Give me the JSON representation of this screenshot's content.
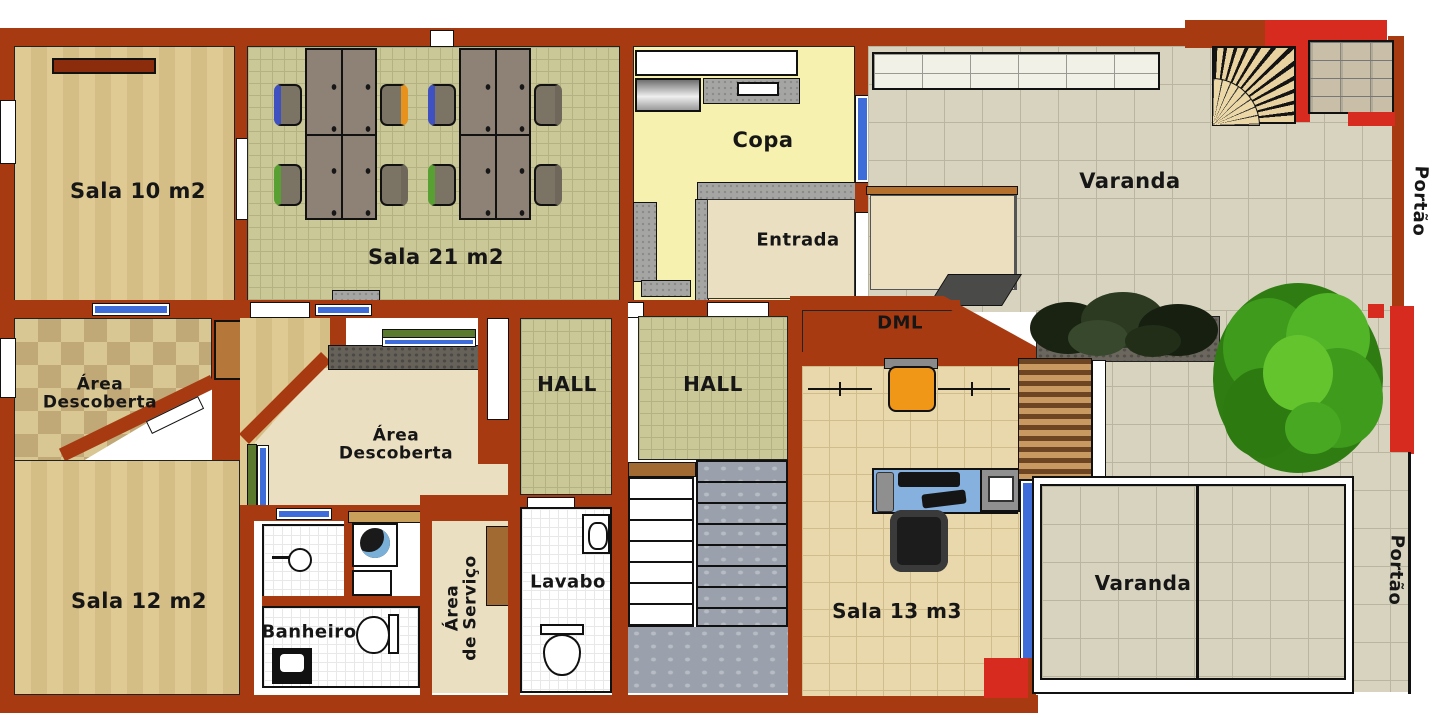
{
  "rooms": {
    "sala10": {
      "label": "Sala 10 m2"
    },
    "sala21": {
      "label": "Sala 21 m2"
    },
    "copa": {
      "label": "Copa"
    },
    "entrada": {
      "label": "Entrada"
    },
    "varanda_top": {
      "label": "Varanda"
    },
    "portao_top": {
      "label": "Portão"
    },
    "dml": {
      "label": "DML"
    },
    "area_descoberta_left": {
      "line1": "Área",
      "line2": "Descoberta"
    },
    "area_descoberta_mid": {
      "line1": "Área",
      "line2": "Descoberta"
    },
    "hall_left": {
      "label": "HALL"
    },
    "hall_mid": {
      "label": "HALL"
    },
    "sala12": {
      "label": "Sala 12 m2"
    },
    "banheiro": {
      "label": "Banheiro"
    },
    "area_servico": {
      "line1": "Área",
      "line2": "de Serviço"
    },
    "lavabo": {
      "label": "Lavabo"
    },
    "sala13": {
      "label": "Sala 13 m3"
    },
    "varanda_bottom": {
      "label": "Varanda"
    },
    "portao_bottom": {
      "label": "Portão"
    }
  },
  "palette": {
    "wall_brick": "#a83a12",
    "wall_bright_red": "#d62b1e",
    "wood_floor": "#e0ca94",
    "olive_tile": "#cbc897",
    "tan_tile": "#e8d8ab",
    "gray_tile": "#d7d3bf",
    "checker_tile": "#c1a977",
    "copa_yellow": "#f6f1ae",
    "beige": "#ebdfc2",
    "window_blue": "#3e6cd8",
    "hedge_green": "#5a7a2e",
    "tree_green": "#3e9b1c",
    "marble_gray": "#9ba1ac",
    "desk_blue": "#86b0dd",
    "chair_blue": "#3f51c0",
    "chair_orange": "#e8921e",
    "chair_green": "#58a032",
    "label_color": "#161616"
  }
}
